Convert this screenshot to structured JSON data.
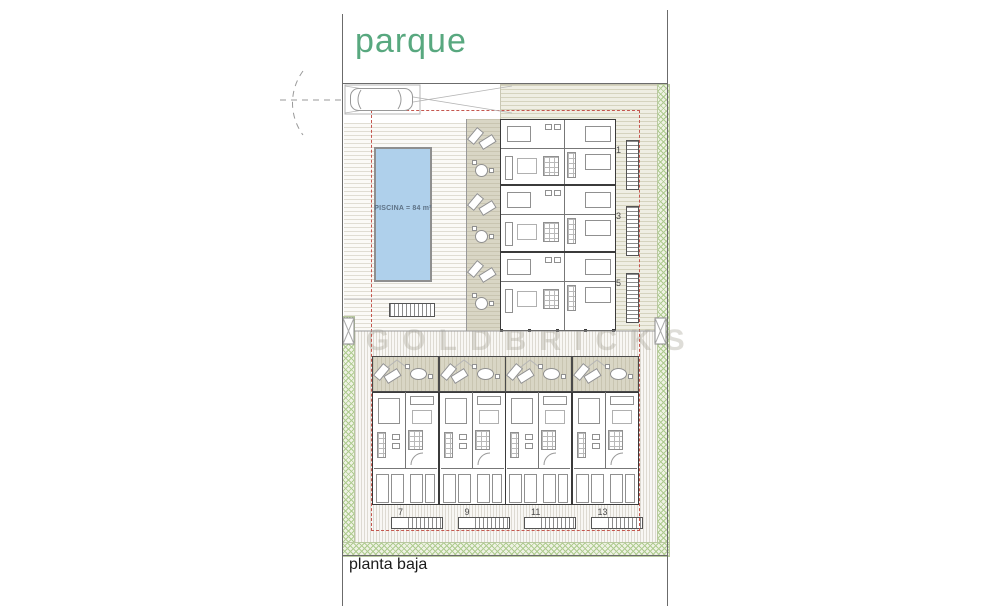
{
  "title": "parque",
  "floor_label": "planta baja",
  "pool": {
    "label": "PISCINA = 84 m²"
  },
  "watermark": "GOLDBRICKS",
  "units_upper": [
    "1",
    "3",
    "5"
  ],
  "units_lower": [
    "7",
    "9",
    "11",
    "13"
  ],
  "colors": {
    "accent_green": "#58a87f",
    "pool_fill": "#afd0eb",
    "boundary_red": "#c4564e",
    "hatch_green": "#aecb8f",
    "terrace_beige": "#d9d6c5"
  }
}
